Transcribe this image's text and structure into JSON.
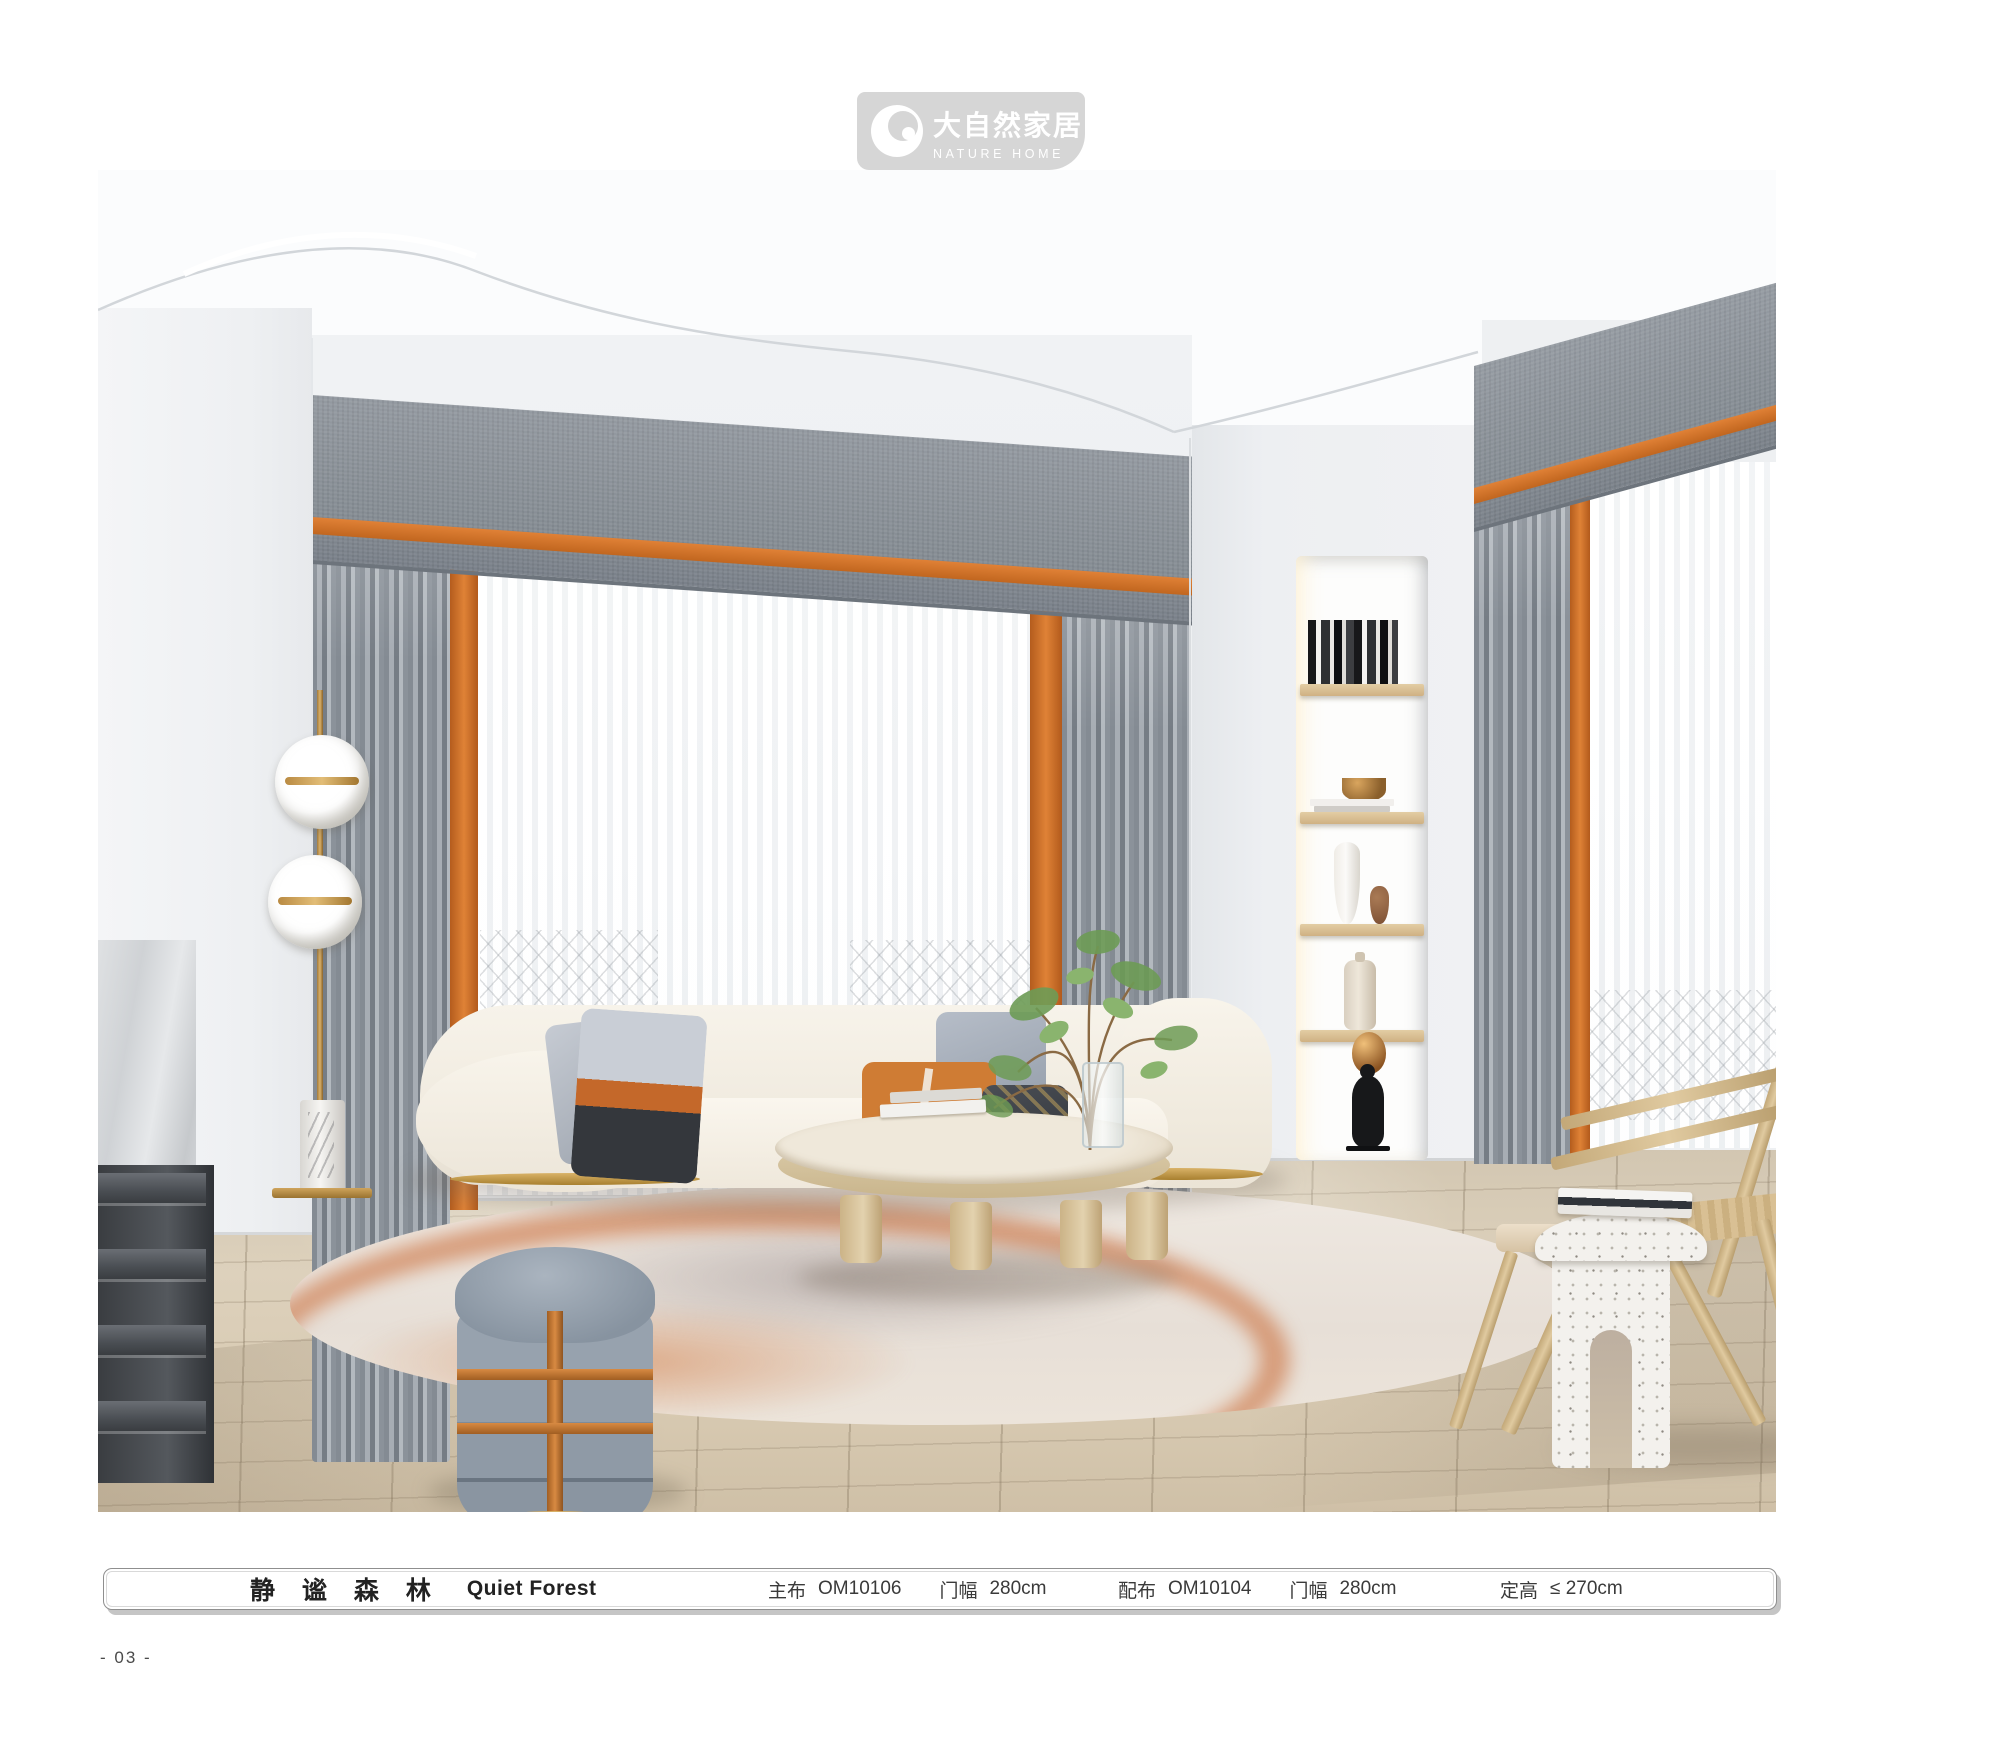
{
  "page": {
    "number": "- 03 -"
  },
  "logo": {
    "name_zh": "大自然家居",
    "name_en": "NATURE HOME",
    "mark_icon": "crescent-circle-icon",
    "badge_color": "#d6d6d6"
  },
  "info_bar": {
    "series_zh": "静 谧 森 林",
    "series_en": "Quiet Forest",
    "specs": [
      {
        "label": "主布",
        "value": "OM10106"
      },
      {
        "label": "门幅",
        "value": "280cm"
      },
      {
        "label": "配布",
        "value": "OM10104"
      },
      {
        "label": "门幅",
        "value": "280cm"
      },
      {
        "label": "定高",
        "value": "≤ 270cm"
      }
    ]
  },
  "scene_colors": {
    "accent_orange": "#D2702F",
    "valance_gray": "#8A9197",
    "curtain_gray": "#9BA1A8",
    "sofa_cream": "#F4EFE6",
    "wood": "#D8C5A0",
    "gold": "#C39A52"
  }
}
